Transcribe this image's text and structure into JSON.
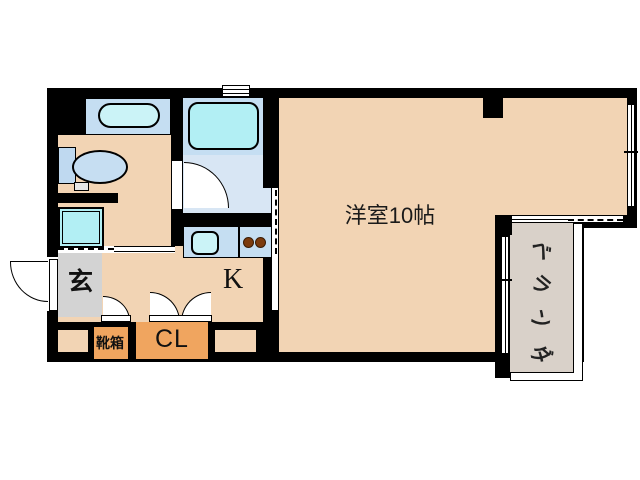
{
  "labels": {
    "main_room": "洋室10帖",
    "kitchen": "K",
    "entrance": "玄",
    "shoe_box": "靴箱",
    "closet": "CL",
    "veranda": "ベランダ",
    "veranda_chars": [
      "ベ",
      "ラ",
      "ン",
      "ダ"
    ]
  },
  "colors": {
    "background": "#FFFFFF",
    "wall": "#000000",
    "floor_tan": "#F2D4B4",
    "entrance_gray": "#D3D3D3",
    "closet_orange": "#F0A55F",
    "bath_blue": "#C5DEF2",
    "bath_floor_blue": "#D8E6F4",
    "fixture_cyan": "#B2EFF4",
    "basin_cyan": "#CBF3F7",
    "toilet_blue": "#C6DEF2",
    "tank_blue": "#BFD9F0",
    "burner_brown": "#7B3B0E",
    "veranda_gray": "#D9D1C9"
  }
}
